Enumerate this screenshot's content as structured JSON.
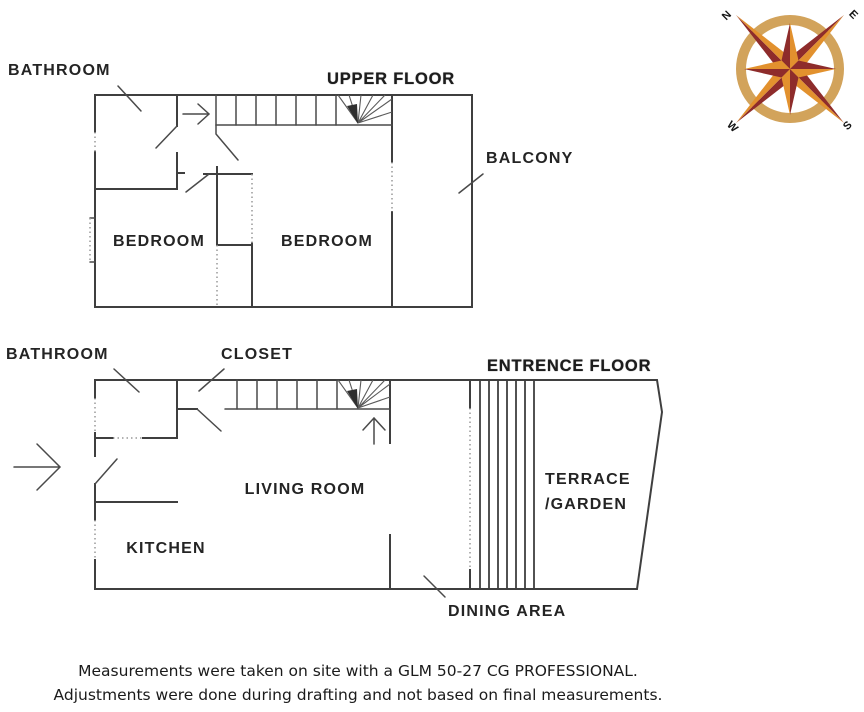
{
  "upper_floor": {
    "title": "UPPER FLOOR",
    "labels": {
      "bathroom": "BATHROOM",
      "bedroom_left": "BEDROOM",
      "bedroom_right": "BEDROOM",
      "balcony": "BALCONY"
    }
  },
  "entrance_floor": {
    "title": "ENTRENCE FLOOR",
    "labels": {
      "bathroom": "BATHROOM",
      "closet": "CLOSET",
      "living_room": "LIVING ROOM",
      "kitchen": "KITCHEN",
      "terrace_line1": "TERRACE",
      "terrace_line2": "/GARDEN",
      "dining_area": "DINING AREA"
    }
  },
  "compass": {
    "letters": {
      "n": "N",
      "e": "E",
      "s": "S",
      "w": "W"
    },
    "colors": {
      "ring": "#d2a35b",
      "dark": "#8e2c2b",
      "light": "#e2912e"
    }
  },
  "disclaimer": {
    "line1": "Measurements were taken on site with a GLM 50-27 CG PROFESSIONAL.",
    "line2": "Adjustments were done during drafting and not based on final measurements."
  }
}
